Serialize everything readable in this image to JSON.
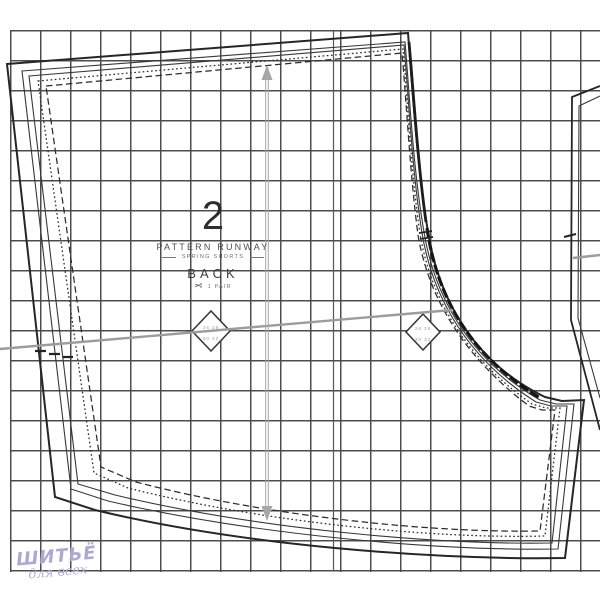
{
  "pattern_label": {
    "piece_number": "2",
    "brand": "PATTERN RUNWAY",
    "garment": "SPRING SHORTS",
    "piece_name": "BACK",
    "cutting_instruction": "1 PAIR",
    "scissors_icon": "✂"
  },
  "size_diamonds": {
    "left": {
      "rows": [
        "26 28",
        "30 32"
      ]
    },
    "right": {
      "rows": [
        "26 28",
        "30 32"
      ]
    }
  },
  "watermark": {
    "line1": "ШИТЬЁ",
    "line2": "для всех",
    "color": "#aca8d6"
  },
  "grid": {
    "cell_px": 30,
    "line_color": "#4c4c4c"
  },
  "colors": {
    "pattern_line": "#262626",
    "guide_gray": "#9c9c9c",
    "arrow_gray": "#a6a6a6"
  },
  "icons": {
    "grainline_arrow": "double-headed-vertical-arrow",
    "notch_diamond": "diamond-notch-marker"
  }
}
